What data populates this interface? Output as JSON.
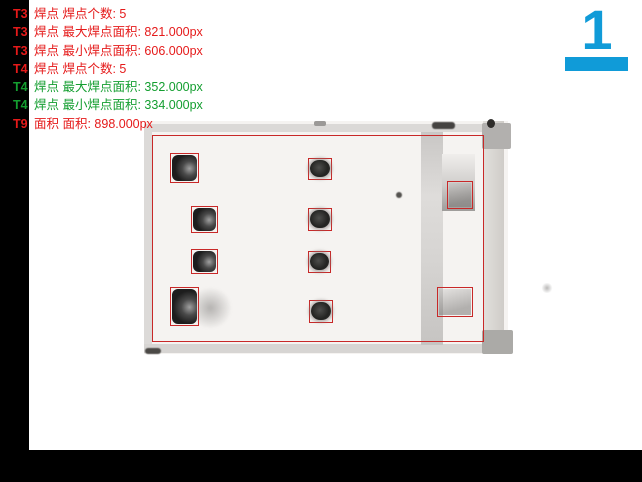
{
  "window": {
    "background": "#ffffff",
    "frame_color": "#000000"
  },
  "results_panel": {
    "lines": [
      {
        "tag": "T3",
        "text": "焊点 焊点个数: 5",
        "color": "#e51a1a"
      },
      {
        "tag": "T3",
        "text": "焊点 最大焊点面积: 821.000px",
        "color": "#e51a1a"
      },
      {
        "tag": "T3",
        "text": "焊点 最小焊点面积: 606.000px",
        "color": "#e51a1a"
      },
      {
        "tag": "T4",
        "text": "焊点 焊点个数: 5",
        "color": "#e51a1a"
      },
      {
        "tag": "T4",
        "text": "焊点 最大焊点面积: 352.000px",
        "color": "#149e30"
      },
      {
        "tag": "T4",
        "text": "焊点 最小焊点面积: 334.000px",
        "color": "#149e30"
      },
      {
        "tag": "T9",
        "text": "面积 面积: 898.000px",
        "color": "#e51a1a"
      }
    ]
  },
  "page_indicator": {
    "number": "1",
    "accent_color": "#109bd8"
  },
  "inspection_overlay": {
    "box_color": "#c82828",
    "main_region": {
      "x": 152,
      "y": 135,
      "w": 332,
      "h": 207
    },
    "detection_boxes": [
      {
        "id": "L1",
        "kind": "pad-large",
        "x": 170,
        "y": 153,
        "w": 29,
        "h": 30
      },
      {
        "id": "L2",
        "kind": "pad-large",
        "x": 191,
        "y": 206,
        "w": 27,
        "h": 27
      },
      {
        "id": "L3",
        "kind": "pad-large",
        "x": 191,
        "y": 249,
        "w": 27,
        "h": 25
      },
      {
        "id": "L4",
        "kind": "pad-large",
        "x": 170,
        "y": 287,
        "w": 29,
        "h": 39
      },
      {
        "id": "M1",
        "kind": "pad-small",
        "x": 308,
        "y": 158,
        "w": 24,
        "h": 22
      },
      {
        "id": "M2",
        "kind": "pad-small",
        "x": 308,
        "y": 208,
        "w": 24,
        "h": 23
      },
      {
        "id": "M3",
        "kind": "pad-small",
        "x": 308,
        "y": 251,
        "w": 23,
        "h": 22
      },
      {
        "id": "M4",
        "kind": "pad-small",
        "x": 309,
        "y": 300,
        "w": 24,
        "h": 23
      },
      {
        "id": "R1",
        "kind": "faint",
        "x": 447,
        "y": 181,
        "w": 26,
        "h": 28
      },
      {
        "id": "R2",
        "kind": "faint",
        "x": 437,
        "y": 287,
        "w": 36,
        "h": 30
      }
    ]
  }
}
